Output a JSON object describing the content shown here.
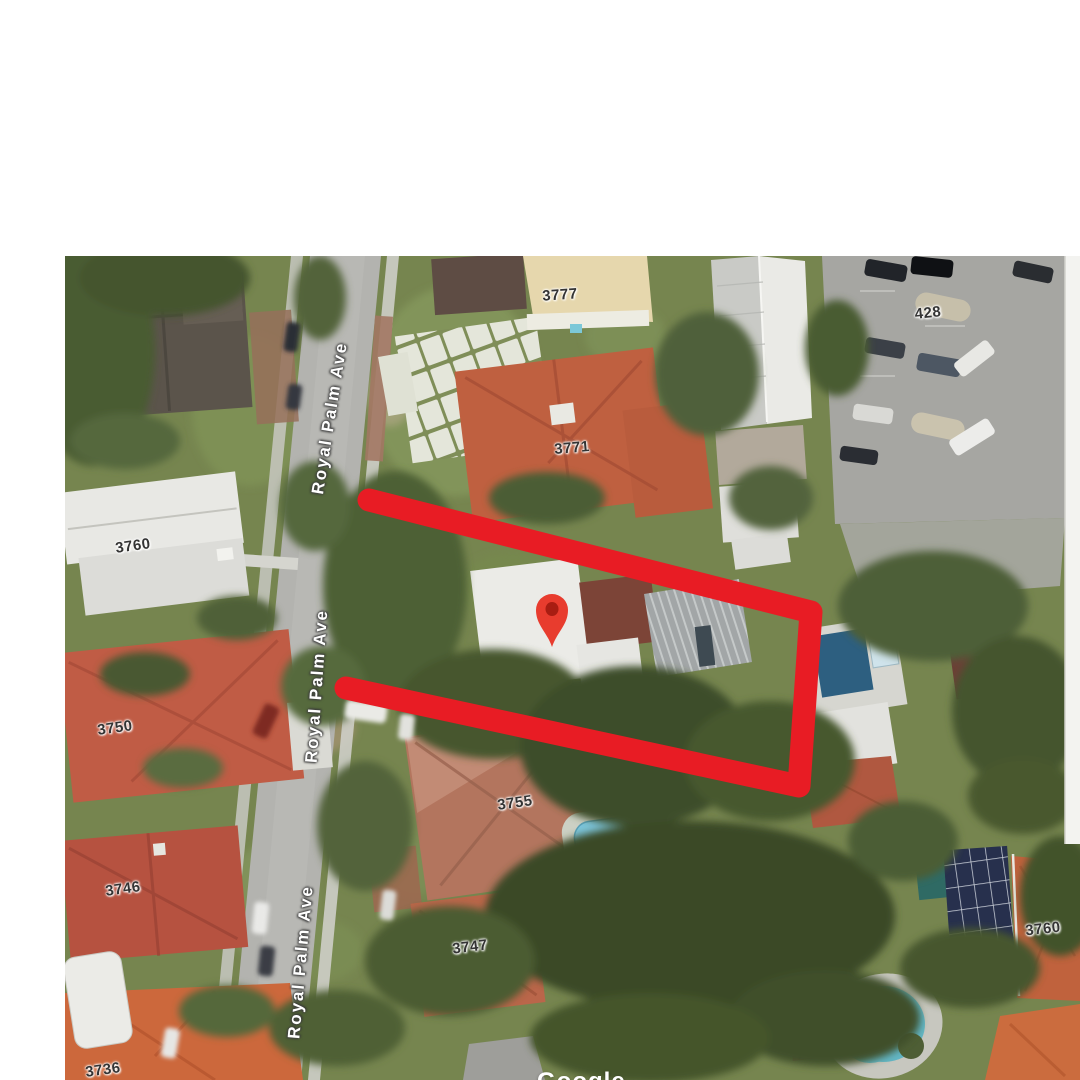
{
  "window": {
    "background": "#ffffff"
  },
  "map": {
    "street_labels": [
      {
        "text": "Royal Palm Ave",
        "x": 265,
        "y": 162,
        "rotate": -81
      },
      {
        "text": "Royal Palm Ave",
        "x": 252,
        "y": 430,
        "rotate": -86
      },
      {
        "text": "Royal Palm Ave",
        "x": 236,
        "y": 706,
        "rotate": -85
      }
    ],
    "house_numbers": [
      {
        "text": "3777",
        "x": 495,
        "y": 39,
        "rotate": -4
      },
      {
        "text": "3771",
        "x": 507,
        "y": 192,
        "rotate": -5
      },
      {
        "text": "428",
        "x": 863,
        "y": 57,
        "rotate": -6
      },
      {
        "text": "3760",
        "x": 68,
        "y": 290,
        "rotate": -8
      },
      {
        "text": "3750",
        "x": 50,
        "y": 472,
        "rotate": -8
      },
      {
        "text": "3755",
        "x": 450,
        "y": 547,
        "rotate": -8
      },
      {
        "text": "3746",
        "x": 58,
        "y": 633,
        "rotate": -8
      },
      {
        "text": "3747",
        "x": 405,
        "y": 691,
        "rotate": -7
      },
      {
        "text": "3760",
        "x": 978,
        "y": 673,
        "rotate": -6
      },
      {
        "text": "3736",
        "x": 38,
        "y": 814,
        "rotate": -8
      }
    ],
    "watermark": {
      "text": "Google"
    },
    "marker": {
      "color": "#e83c2e",
      "inner_color": "#a81d12"
    },
    "highlight": {
      "color": "#e81c24"
    }
  }
}
